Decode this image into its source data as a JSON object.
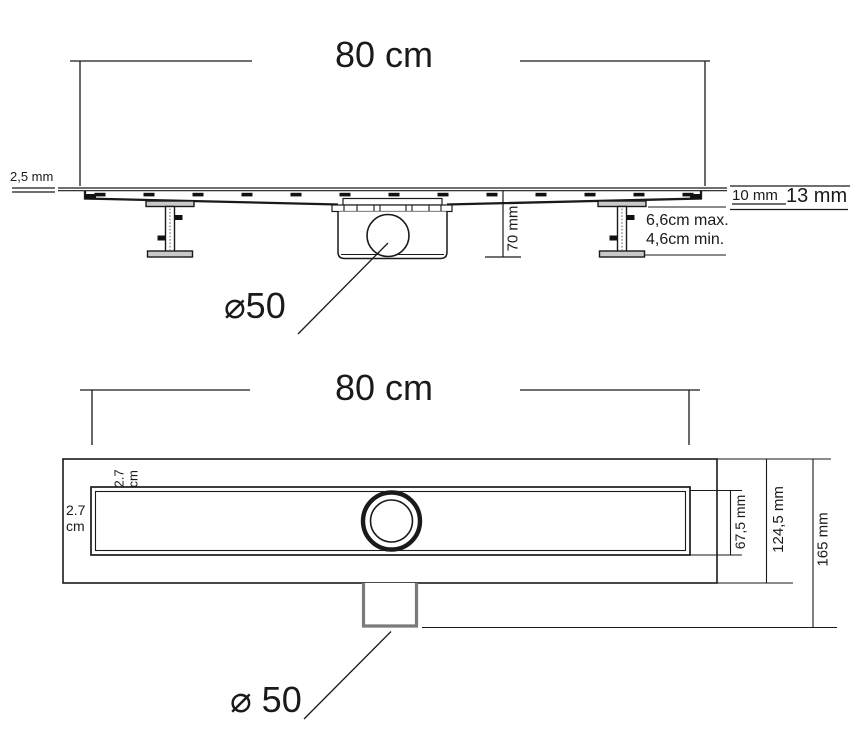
{
  "side_view": {
    "length": "80 cm",
    "plate_thickness": "2,5 mm",
    "trap_height": "70 mm",
    "grate_edge": "10 mm",
    "frame_edge": "13 mm",
    "feet_max": "6,6cm max.",
    "feet_min": "4,6cm min.",
    "outlet_diameter": "⌀50"
  },
  "plan_view": {
    "length": "80 cm",
    "top_gap": "2.7\ncm",
    "side_gap": "2.7\ncm",
    "channel_width": "67,5 mm",
    "flange_width": "124,5 mm",
    "total_width": "165 mm",
    "outlet_diameter": "⌀ 50"
  },
  "colors": {
    "line": "#1a1a1a",
    "metal_fill": "#c9c9c9",
    "outlet_gray": "#7a7a7a",
    "background": "#ffffff"
  }
}
